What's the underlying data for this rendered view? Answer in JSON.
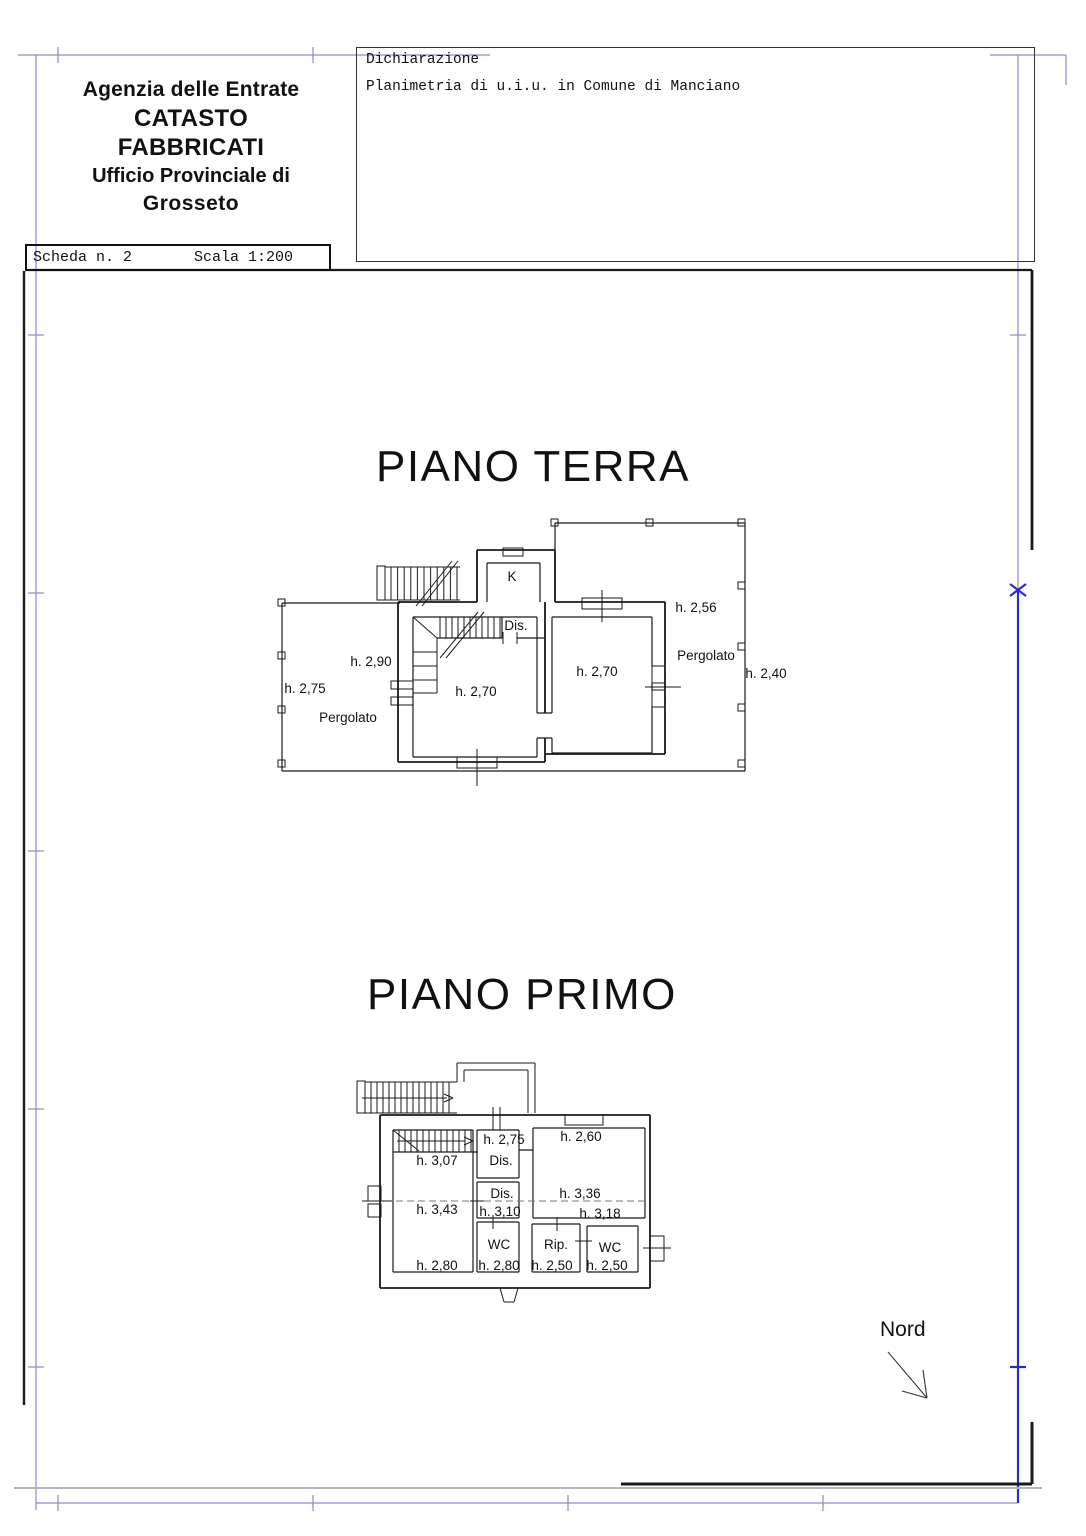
{
  "header": {
    "line1": "Agenzia delle Entrate",
    "line2": "CATASTO FABBRICATI",
    "line3": "Ufficio Provinciale di",
    "line4": "Grosseto"
  },
  "declaration_box": {
    "title": "Dichiarazione",
    "body": "Planimetria di u.i.u. in Comune di Manciano"
  },
  "sheet_box": {
    "scheda": "Scheda n. 2",
    "scala": "Scala 1:200"
  },
  "floors": {
    "ground": {
      "title": "PIANO TERRA",
      "labels": [
        {
          "text": "K",
          "x": 512,
          "y": 581
        },
        {
          "text": "Dis.",
          "x": 516,
          "y": 630
        },
        {
          "text": "h. 2,90",
          "x": 371,
          "y": 666
        },
        {
          "text": "h. 2,70",
          "x": 476,
          "y": 696
        },
        {
          "text": "h. 2,70",
          "x": 597,
          "y": 676
        },
        {
          "text": "h. 2,56",
          "x": 696,
          "y": 612
        },
        {
          "text": "Pergolato",
          "x": 706,
          "y": 660
        },
        {
          "text": "h. 2,40",
          "x": 766,
          "y": 678
        },
        {
          "text": "h. 2,75",
          "x": 305,
          "y": 693
        },
        {
          "text": "Pergolato",
          "x": 348,
          "y": 722
        }
      ]
    },
    "first": {
      "title": "PIANO PRIMO",
      "labels": [
        {
          "text": "h. 2,75",
          "x": 504,
          "y": 1144
        },
        {
          "text": "Dis.",
          "x": 501,
          "y": 1165
        },
        {
          "text": "h. 2,60",
          "x": 581,
          "y": 1141
        },
        {
          "text": "h. 3,07",
          "x": 437,
          "y": 1165
        },
        {
          "text": "h. 3,43",
          "x": 437,
          "y": 1214
        },
        {
          "text": "Dis.",
          "x": 502,
          "y": 1198
        },
        {
          "text": "h. 3,10",
          "x": 500,
          "y": 1216
        },
        {
          "text": "h. 3,36",
          "x": 580,
          "y": 1198
        },
        {
          "text": "h. 3,18",
          "x": 600,
          "y": 1218
        },
        {
          "text": "WC",
          "x": 499,
          "y": 1249
        },
        {
          "text": "h. 2,80",
          "x": 437,
          "y": 1270
        },
        {
          "text": "h. 2,80",
          "x": 499,
          "y": 1270
        },
        {
          "text": "Rip.",
          "x": 556,
          "y": 1249
        },
        {
          "text": "h. 2,50",
          "x": 552,
          "y": 1270
        },
        {
          "text": "WC",
          "x": 610,
          "y": 1252
        },
        {
          "text": "h. 2,50",
          "x": 607,
          "y": 1270
        }
      ]
    }
  },
  "north": {
    "label": "Nord"
  },
  "colors": {
    "ink": "#1a1a1a",
    "frame_blue": "#8a8ace",
    "frame_blue_strong": "#2b2bd0",
    "gray_line": "#b5b5b5"
  }
}
